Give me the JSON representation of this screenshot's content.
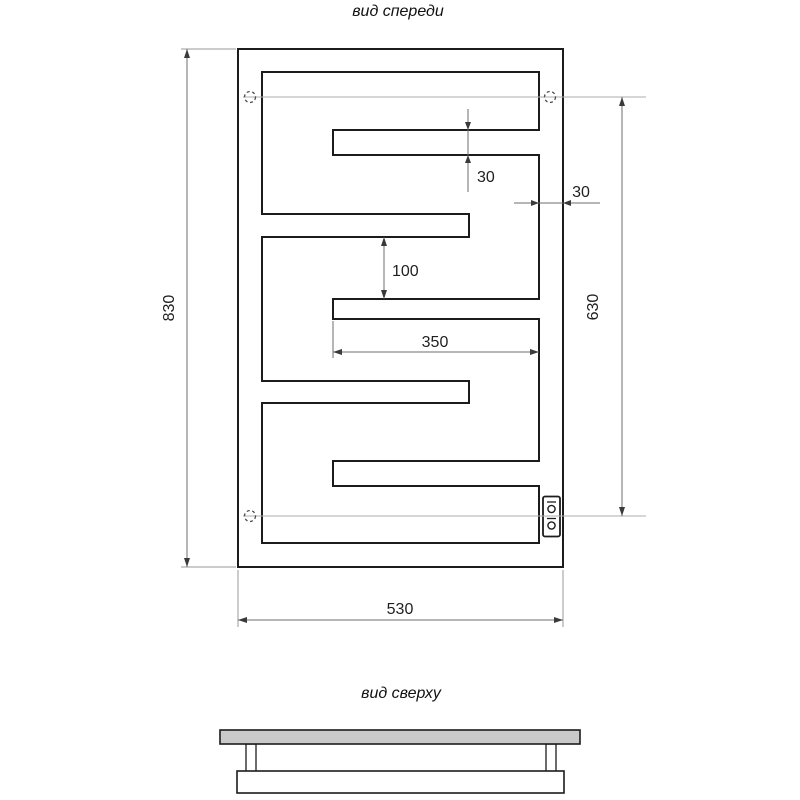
{
  "drawing": {
    "type": "technical-drawing",
    "subject": "flat serpentine heated towel rail, front and top orthographic views",
    "front_view": {
      "title": "вид спереди",
      "dimensions": {
        "overall_height": "830",
        "mount_span_height": "630",
        "overall_width": "530",
        "slot_length": "350",
        "band_height": "100",
        "slot_gap": "30",
        "side_margin": "30"
      },
      "features": {
        "mount_points": 3,
        "electrical_box_terminals": 2
      }
    },
    "top_view": {
      "title": "вид сверху"
    },
    "colors": {
      "background": "#ffffff",
      "object_line": "#1c1c1c",
      "dimension_line": "#6e6e6e",
      "extension_line": "#9a9a9a",
      "centerline": "#aeaeae",
      "arrow": "#3a3a3a",
      "bracket_fill": "#c9c9c9"
    }
  }
}
